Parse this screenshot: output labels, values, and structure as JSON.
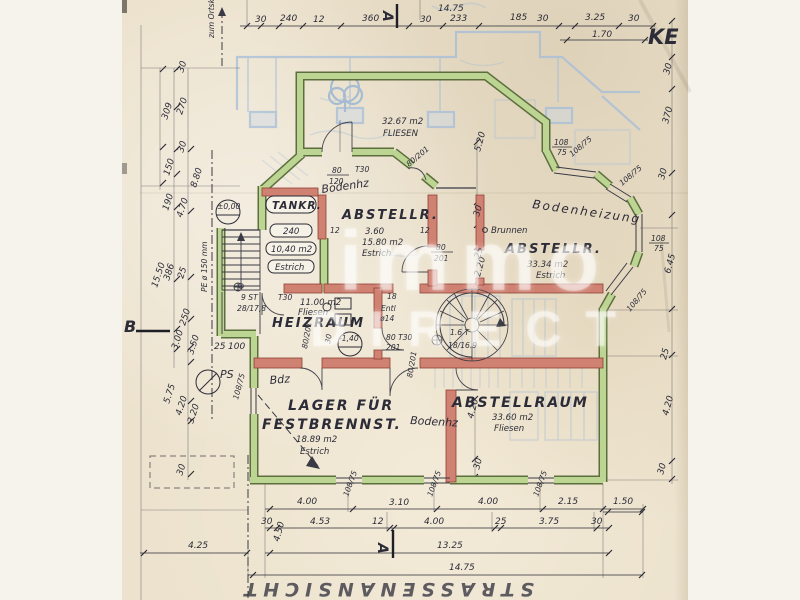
{
  "titles": {
    "corner": "KE",
    "street": "STRASSENANSICHT",
    "direction": "zum Ortskern",
    "section_a": "A",
    "section_b": "B"
  },
  "watermark": {
    "l1": "immo",
    "l2": "DIRECT"
  },
  "rooms": {
    "top": {
      "area": "32.67 m2",
      "finish": "FLIESEN"
    },
    "tank": {
      "name": "TANKR.",
      "w": "240",
      "area": "10,40 m2",
      "finish": "Estrich"
    },
    "ab1": {
      "name": "ABSTELLR.",
      "w": "3.60",
      "area": "15.80 m2",
      "finish": "Estrich"
    },
    "ab2": {
      "name": "ABSTELLR.",
      "area": "33.34 m2",
      "finish": "Estrich"
    },
    "heiz": {
      "name": "HEIZRAUM",
      "area": "11.00 m2",
      "finish": "Fliesen"
    },
    "lager": {
      "n1": "LAGER FÜR",
      "n2": "FESTBRENNST.",
      "area": "18.89 m2",
      "finish": "Estrich"
    },
    "ab3": {
      "name": "ABSTELLRAUM",
      "area": "33.60 m2",
      "finish": "Fliesen"
    }
  },
  "levels": {
    "zero": "±0,00",
    "minus": "-1,40"
  },
  "notes": {
    "well": "Brunnen",
    "ps": "PS",
    "pipe": "PE ø 150 mm",
    "heating_pencil": "Bodenheizung",
    "heating_red1": "Bodenhz",
    "heating_red2": "Bodenhz",
    "heating_red3": "Bdz",
    "stairs_count": "9 ST",
    "stairs_step": "28/17,8",
    "vent": "Entl",
    "vent_d": "ø14",
    "spiral1": "1.6 T",
    "spiral2": "18/16.9",
    "w18": "18",
    "w30": "30",
    "w12": "12"
  },
  "doors": {
    "t30": "T30",
    "d80_120": [
      "80",
      "120"
    ],
    "d80_201s": [
      "80",
      "201"
    ],
    "d80_201": "80/201",
    "d80t30": "80 T30",
    "d201": "201"
  },
  "win": {
    "s": "108/75",
    "w": "108",
    "h": "75"
  },
  "dims": {
    "top": [
      "30",
      "240",
      "12",
      "360",
      "30",
      "233",
      "185",
      "30",
      "3.25",
      "30"
    ],
    "top_sub": "1.70",
    "top_total": "14.75",
    "left": [
      "30",
      "309",
      "270",
      "30",
      "150",
      "8.80",
      "190",
      "4.70",
      "15.50",
      "386",
      "25",
      "250",
      "3.00",
      "3.50",
      "25",
      "100",
      "5.75",
      "4.20",
      "3.20",
      "30"
    ],
    "left_total": "4.25",
    "right": [
      "30",
      "370",
      "30",
      "6.45",
      "25",
      "4.20",
      "30"
    ],
    "inner": [
      "5.20",
      "30",
      "25",
      "2.20",
      "4.20",
      "30",
      "4.50"
    ],
    "b1": [
      "4.00",
      "3.10",
      "4.00",
      "2.15",
      "1.50"
    ],
    "b2": [
      "30",
      "4.53",
      "12",
      "4.00",
      "25",
      "3.75",
      "30"
    ],
    "b_total1": "13.25",
    "b_total2": "14.75"
  }
}
